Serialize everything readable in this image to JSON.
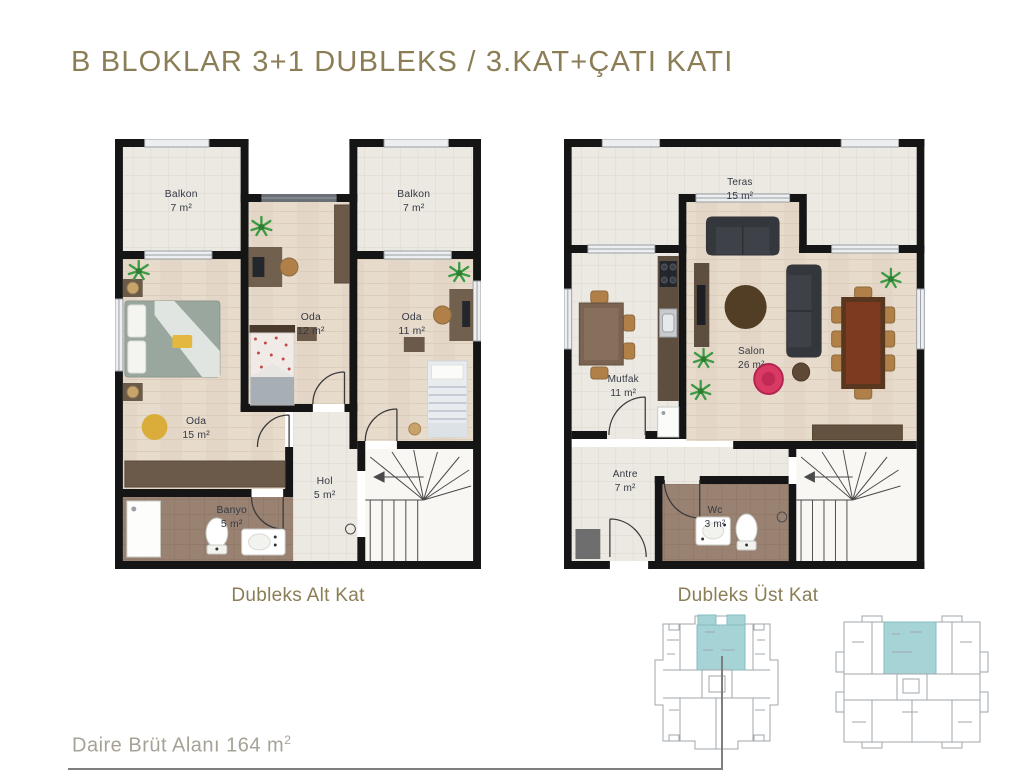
{
  "header": {
    "title": "B BLOKLAR 3+1 DUBLEKS / 3.KAT+ÇATI KATI"
  },
  "plans": [
    {
      "caption": "Dubleks Alt Kat",
      "rooms": [
        {
          "name": "Balkon",
          "area": "7 m²"
        },
        {
          "name": "Oda",
          "area": "12 m²"
        },
        {
          "name": "Balkon",
          "area": "7 m²"
        },
        {
          "name": "Oda",
          "area": "11 m²"
        },
        {
          "name": "Oda",
          "area": "15 m²"
        },
        {
          "name": "Hol",
          "area": "5 m²"
        },
        {
          "name": "Banyo",
          "area": "5 m²"
        }
      ]
    },
    {
      "caption": "Dubleks Üst Kat",
      "rooms": [
        {
          "name": "Teras",
          "area": "15 m²"
        },
        {
          "name": "Mutfak",
          "area": "11 m²"
        },
        {
          "name": "Salon",
          "area": "26 m²"
        },
        {
          "name": "Antre",
          "area": "7 m²"
        },
        {
          "name": "Wc",
          "area": "3 m²"
        }
      ]
    }
  ],
  "footer": {
    "area_label": "Daire Brüt Alanı 164 m",
    "area_sup": "2"
  },
  "colors": {
    "title_olive": "#8B7D55",
    "footer_gray": "#A6A396",
    "wall_black": "#151515",
    "keyplan_highlight": "#A6D3D6",
    "wood_floor": "#E7DBCC",
    "tile_floor": "#ECE9E2",
    "bath_tile": "#998272"
  }
}
